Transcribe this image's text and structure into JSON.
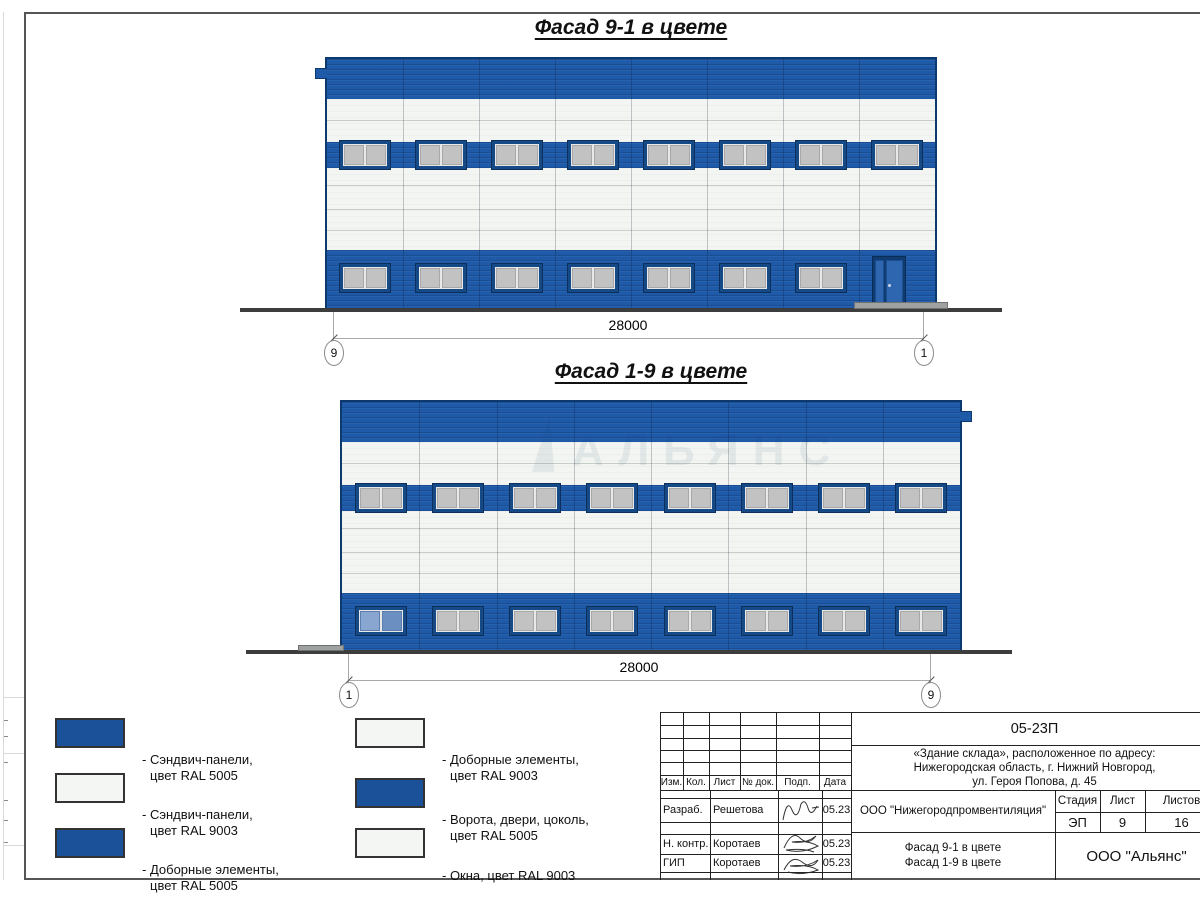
{
  "facades": [
    {
      "title": "Фасад 9-1 в цвете",
      "dimension": "28000",
      "marker_left": "9",
      "marker_right": "1",
      "columns": 8,
      "middle_windows": 8,
      "bottom_windows": 7,
      "door": true,
      "blue_window_index": -1
    },
    {
      "title": "Фасад 1-9 в цвете",
      "dimension": "28000",
      "marker_left": "1",
      "marker_right": "9",
      "columns": 8,
      "middle_windows": 8,
      "bottom_windows": 8,
      "door": false,
      "blue_window_index": 0,
      "watermark": "АЛЬЯНС"
    }
  ],
  "legend": {
    "items": [
      {
        "swatch": "blue",
        "line1": "- Сэндвич-панели,",
        "line2": "цвет RAL 5005"
      },
      {
        "swatch": "white",
        "line1": "- Сэндвич-панели,",
        "line2": "цвет RAL 9003"
      },
      {
        "swatch": "blue",
        "line1": "- Доборные элементы,",
        "line2": "цвет RAL 5005"
      },
      {
        "swatch": "white",
        "line1": "- Доборные элементы,",
        "line2": "цвет RAL 9003"
      },
      {
        "swatch": "blue",
        "line1": "- Ворота, двери, цоколь,",
        "line2": "цвет RAL 5005"
      },
      {
        "swatch": "white",
        "line1": "- Окна, цвет RAL 9003",
        "line2": ""
      }
    ]
  },
  "colors": {
    "ral5005_panel": "#1e5aa8",
    "ral9003_panel": "#f2f5f1",
    "legend_blue": "#1b5199",
    "ground": "#3d3d3d"
  },
  "title_block": {
    "doc_number": "05-23П",
    "address_line1": "«Здание склада», расположенное по адресу:",
    "address_line2": "Нижегородская область, г. Нижний Новгород,",
    "address_line3": "ул. Героя Попова, д. 45",
    "header_cells": [
      "Изм.",
      "Кол.",
      "Лист",
      "№ док.",
      "Подп.",
      "Дата"
    ],
    "rows": [
      {
        "role": "Разраб.",
        "name": "Решетова",
        "date": "05.23"
      },
      {
        "role": "Н. контр.",
        "name": "Коротаев",
        "date": "05.23"
      },
      {
        "role": "ГИП",
        "name": "Коротаев",
        "date": "05.23"
      }
    ],
    "org": "ООО \"Нижегородпромвентиляция\"",
    "stage_label": "Стадия",
    "sheet_label": "Лист",
    "sheets_label": "Листов",
    "stage": "ЭП",
    "sheet": "9",
    "sheets": "16",
    "sheet_title_line1": "Фасад 9-1 в цвете",
    "sheet_title_line2": "Фасад 1-9 в цвете",
    "company": "ООО \"Альянс\""
  }
}
